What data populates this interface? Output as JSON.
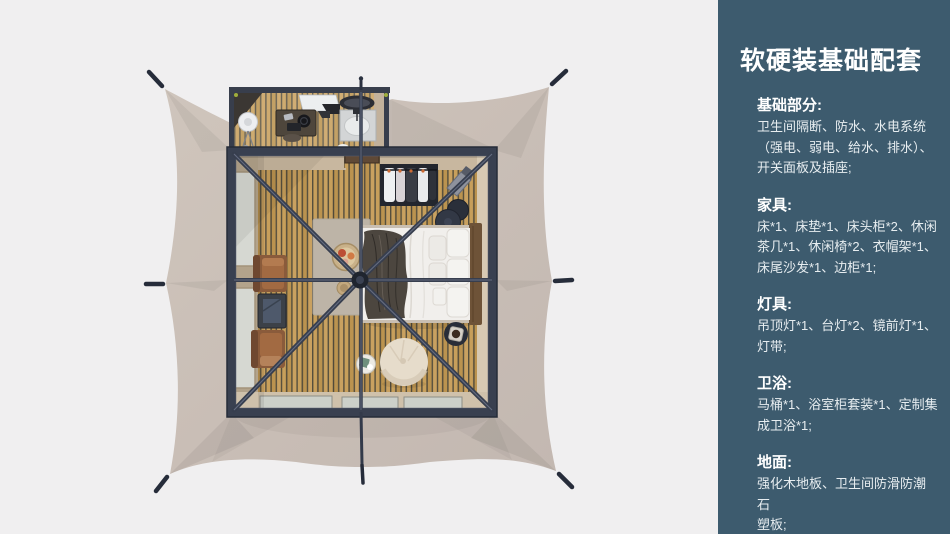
{
  "page": {
    "width": 950,
    "height": 534,
    "background": "#f0eff0"
  },
  "colors": {
    "sidebar_background": "#3d5b6e",
    "heading_text": "#ffffff",
    "body_text": "#e7edf0",
    "tent_canvas": "#c9beb6",
    "structure_frame": "#373e4e",
    "wood_floor": "#c29a55",
    "corner_accent": "#9fae3c"
  },
  "sidebar": {
    "title": "软硬装基础配套",
    "sections": [
      {
        "heading": "基础部分:",
        "body": "卫生间隔断、防水、水电系统\n（强电、弱电、给水、排水）、\n开关面板及插座;"
      },
      {
        "heading": "家具:",
        "body": "床*1、床垫*1、床头柜*2、休闲\n茶几*1、休闲椅*2、衣帽架*1、\n床尾沙发*1、边柜*1;"
      },
      {
        "heading": "灯具:",
        "body": "吊顶灯*1、台灯*2、镜前灯*1、\n灯带;"
      },
      {
        "heading": "卫浴:",
        "body": "马桶*1、浴室柜套装*1、定制集\n成卫浴*1;"
      },
      {
        "heading": "地面:",
        "body": "强化木地板、卫生间防滑防潮石\n塑板;"
      }
    ]
  }
}
